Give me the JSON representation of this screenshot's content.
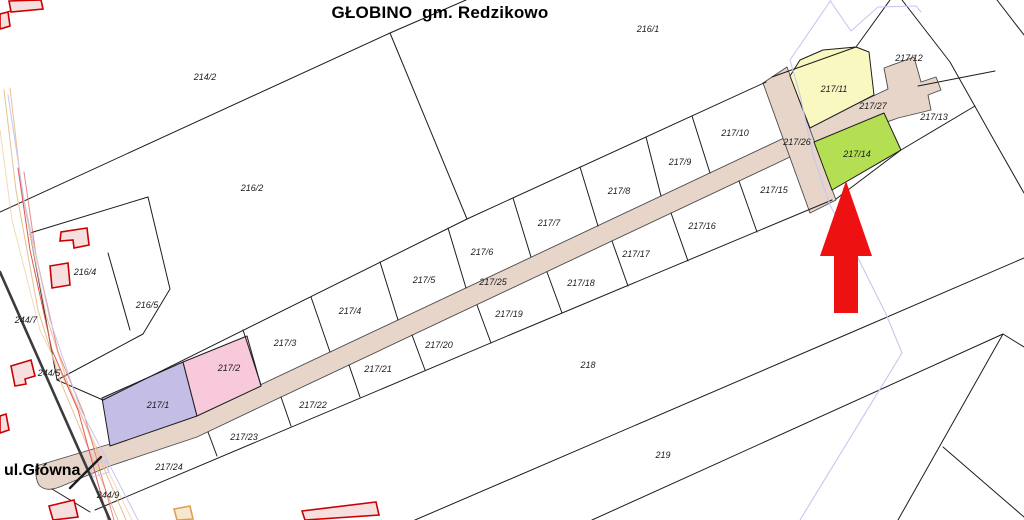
{
  "map": {
    "title": "GŁOBINO  gm. Redzikowo",
    "street_label": "ul.Główna",
    "selected_parcel": "217/14",
    "highlights": {
      "green_selected": "217/14",
      "yellow": "217/11",
      "pink": "217/2",
      "purple": "217/1",
      "road_parcels": [
        "217/25",
        "217/26",
        "217/27"
      ]
    },
    "colors": {
      "background": "#ffffff",
      "boundary": "#1d1d1d",
      "road_fill": "#e7d5ca",
      "highlight_yellow": "#f8f8c0",
      "highlight_green": "#b5df52",
      "highlight_pink": "#f8c9da",
      "highlight_purple": "#c4bde6",
      "arrow_red": "#ee1111",
      "building_stroke": "#cc0000",
      "building_fill": "#f5dfdf",
      "utility_blue": "#c6c6f0",
      "corridor_orange": "#e9c08f",
      "corridor_red": "#e05555",
      "corridor_dark": "#3c3c3c",
      "corridor_tan_shape": "#d9a05a"
    },
    "parcel_labels": [
      {
        "text": "214/2",
        "x": 205,
        "y": 77
      },
      {
        "text": "216/1",
        "x": 648,
        "y": 29
      },
      {
        "text": "216/2",
        "x": 252,
        "y": 188
      },
      {
        "text": "216/4",
        "x": 85,
        "y": 272
      },
      {
        "text": "216/5",
        "x": 147,
        "y": 305
      },
      {
        "text": "244/7",
        "x": 26,
        "y": 320
      },
      {
        "text": "244/5",
        "x": 49,
        "y": 373
      },
      {
        "text": "244/9",
        "x": 108,
        "y": 495
      },
      {
        "text": "217/1",
        "x": 158,
        "y": 405
      },
      {
        "text": "217/2",
        "x": 229,
        "y": 368
      },
      {
        "text": "217/3",
        "x": 285,
        "y": 343
      },
      {
        "text": "217/4",
        "x": 350,
        "y": 311
      },
      {
        "text": "217/5",
        "x": 424,
        "y": 280
      },
      {
        "text": "217/6",
        "x": 482,
        "y": 252
      },
      {
        "text": "217/7",
        "x": 549,
        "y": 223
      },
      {
        "text": "217/8",
        "x": 619,
        "y": 191
      },
      {
        "text": "217/9",
        "x": 680,
        "y": 162
      },
      {
        "text": "217/10",
        "x": 735,
        "y": 133
      },
      {
        "text": "217/11",
        "x": 834,
        "y": 89
      },
      {
        "text": "217/12",
        "x": 909,
        "y": 58
      },
      {
        "text": "217/13",
        "x": 934,
        "y": 117
      },
      {
        "text": "217/14",
        "x": 857,
        "y": 154
      },
      {
        "text": "217/15",
        "x": 774,
        "y": 190
      },
      {
        "text": "217/16",
        "x": 702,
        "y": 226
      },
      {
        "text": "217/17",
        "x": 636,
        "y": 254
      },
      {
        "text": "217/18",
        "x": 581,
        "y": 283
      },
      {
        "text": "217/19",
        "x": 509,
        "y": 314
      },
      {
        "text": "217/20",
        "x": 439,
        "y": 345
      },
      {
        "text": "217/21",
        "x": 378,
        "y": 369
      },
      {
        "text": "217/22",
        "x": 313,
        "y": 405
      },
      {
        "text": "217/23",
        "x": 244,
        "y": 437
      },
      {
        "text": "217/24",
        "x": 169,
        "y": 467
      },
      {
        "text": "217/25",
        "x": 493,
        "y": 282
      },
      {
        "text": "217/26",
        "x": 797,
        "y": 142
      },
      {
        "text": "217/27",
        "x": 873,
        "y": 106
      },
      {
        "text": "218",
        "x": 588,
        "y": 365
      },
      {
        "text": "219",
        "x": 663,
        "y": 455
      }
    ]
  }
}
